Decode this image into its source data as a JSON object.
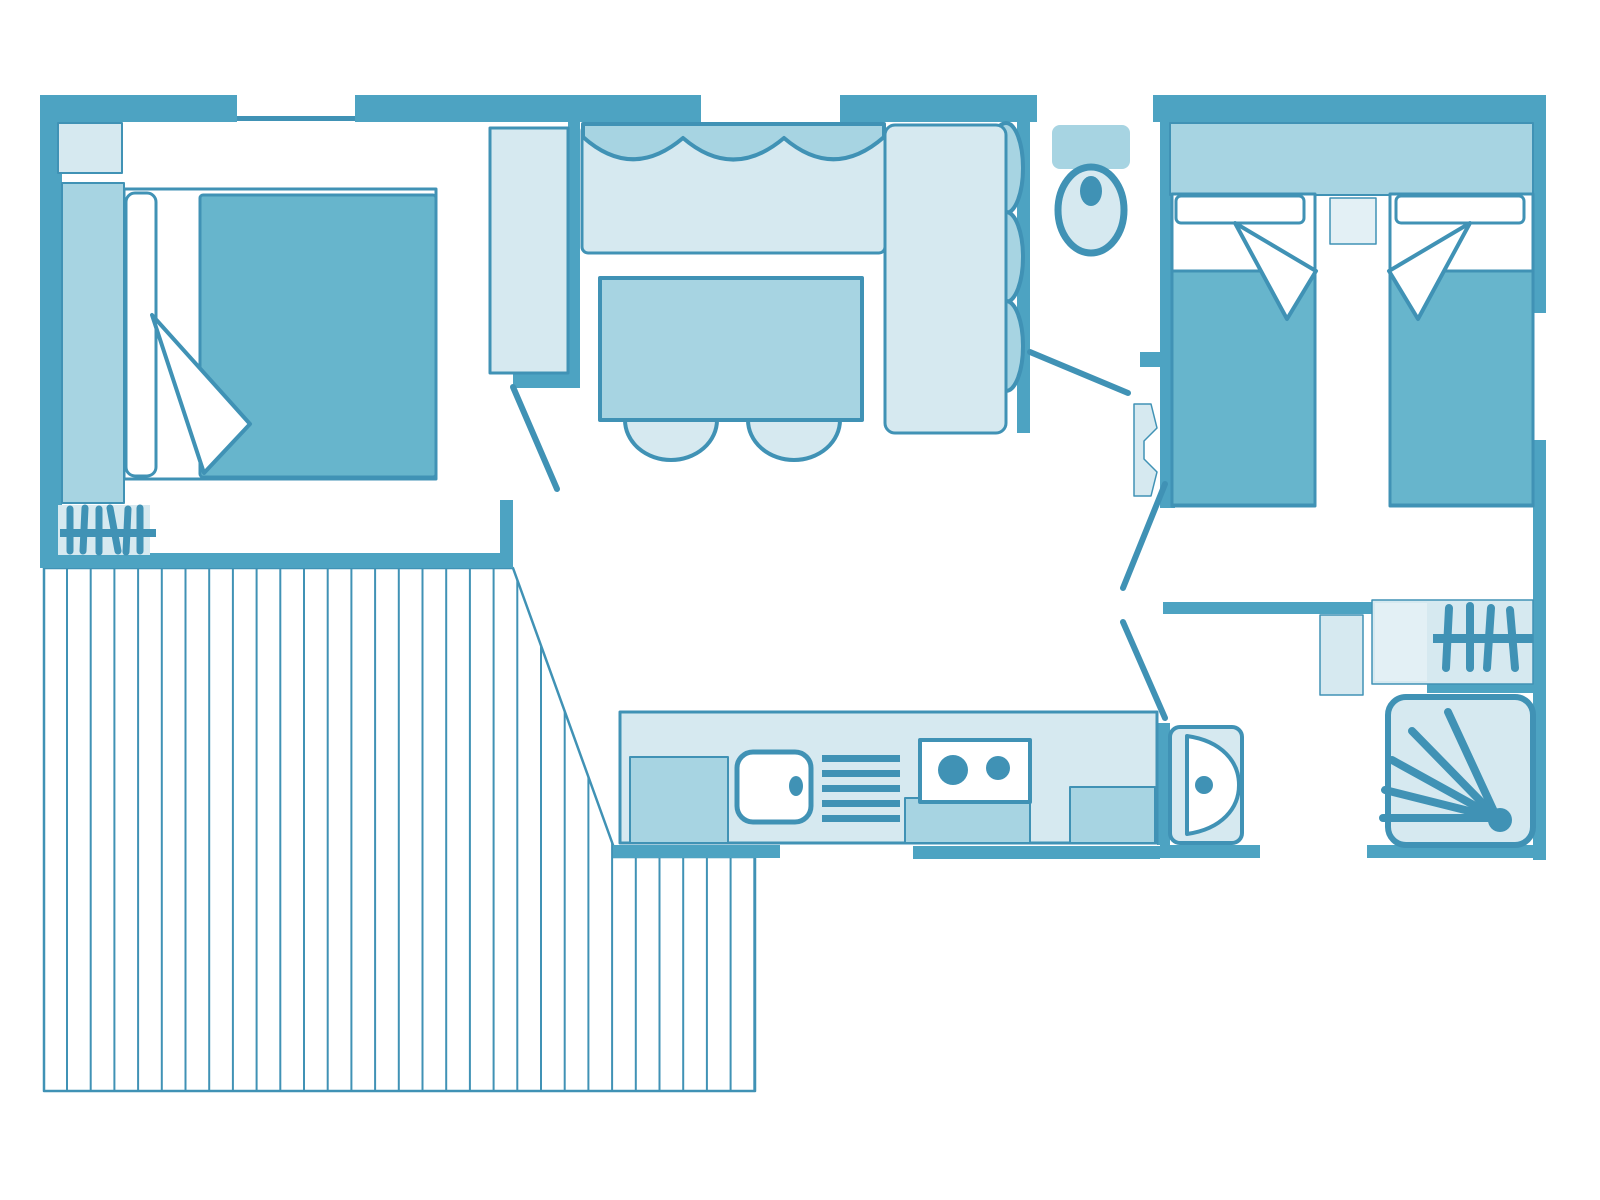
{
  "colors": {
    "wall": "#4da3c2",
    "line": "#4092b5",
    "light": "#d6e9f0",
    "lighter": "#e3f0f5",
    "medium": "#a7d4e2",
    "dark": "#67b5cc"
  },
  "plan": {
    "type": "mobile-home-floor-plan",
    "rooms": [
      {
        "id": "master-bedroom",
        "furniture": [
          "double-bed",
          "headboard",
          "pillow",
          "duvet",
          "folded-sheet",
          "corner-shelf",
          "tall-cabinet",
          "clothes-rail"
        ]
      },
      {
        "id": "living-room",
        "furniture": [
          "corner-sofa",
          "sofa-cushions",
          "dining-table",
          "stool",
          "stool"
        ]
      },
      {
        "id": "wc",
        "furniture": [
          "toilet"
        ]
      },
      {
        "id": "twin-bedroom",
        "furniture": [
          "single-bed",
          "single-bed",
          "headboard",
          "pillow",
          "pillow",
          "nightstand",
          "door-pivot"
        ]
      },
      {
        "id": "kitchen",
        "furniture": [
          "counter",
          "fridge-cabinet",
          "sink",
          "drainer",
          "hob",
          "base-cabinet",
          "base-cabinet"
        ]
      },
      {
        "id": "bathroom",
        "furniture": [
          "washbasin",
          "shower",
          "wardrobe-clothes-rail",
          "wall-cabinet"
        ]
      },
      {
        "id": "hallway",
        "furniture": [
          "door-swing",
          "door-swing",
          "door-swing",
          "door-swing"
        ]
      },
      {
        "id": "terrace",
        "furniture": [
          "wood-decking"
        ]
      }
    ],
    "windows": 6,
    "doors": 4
  }
}
